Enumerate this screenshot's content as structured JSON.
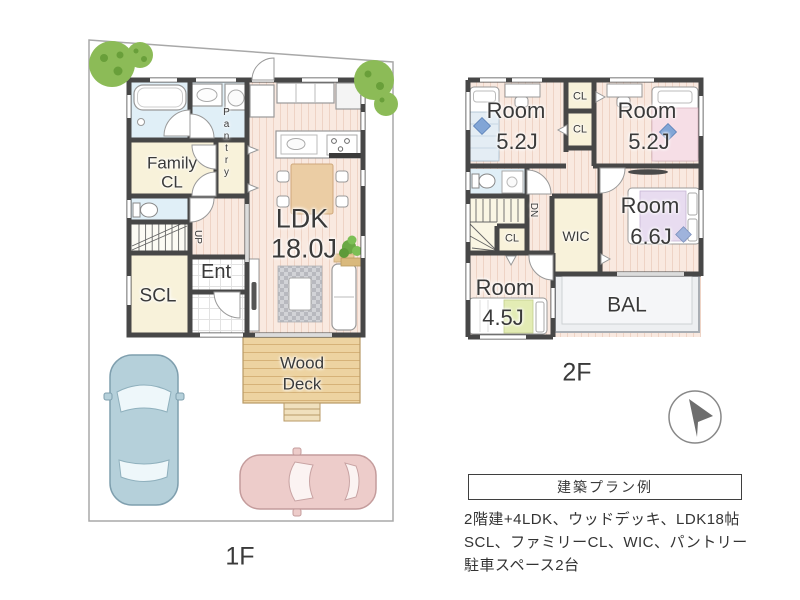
{
  "floor1": {
    "floor_label": "1F",
    "family_cl_line1": "Family",
    "family_cl_line2": "CL",
    "pantry": "Pantry",
    "ldk_name": "LDK",
    "ldk_size": "18.0J",
    "up": "UP",
    "ent": "Ent",
    "scl": "SCL",
    "wood_deck_line1": "Wood",
    "wood_deck_line2": "Deck"
  },
  "floor2": {
    "floor_label": "2F",
    "room_nw_name": "Room",
    "room_nw_size": "5.2J",
    "closet_nw_upper": "CL",
    "closet_nw_lower": "CL",
    "room_ne_name": "Room",
    "room_ne_size": "5.2J",
    "dn": "DN",
    "closet_stairs": "CL",
    "wic": "WIC",
    "room_e_name": "Room",
    "room_e_size": "6.6J",
    "room_sw_name": "Room",
    "room_sw_size": "4.5J",
    "balcony": "BAL"
  },
  "info_box": {
    "title": "建築プラン例",
    "line1": "2階建+4LDK、ウッドデッキ、LDK18帖",
    "line2": "SCL、ファミリーCL、WIC、パントリー",
    "line3": "駐車スペース2台"
  },
  "colors": {
    "wall": "#474747",
    "wood_floor": "#f9e9e0",
    "closet_cream": "#f8f2da",
    "wet_area_blue": "#e0eff7",
    "deck_tan": "#edd3a1",
    "balcony_gray": "#edeff1",
    "tree_green": "#8cbb57",
    "car_blue": "#b5d0da",
    "car_pink": "#edccca"
  }
}
